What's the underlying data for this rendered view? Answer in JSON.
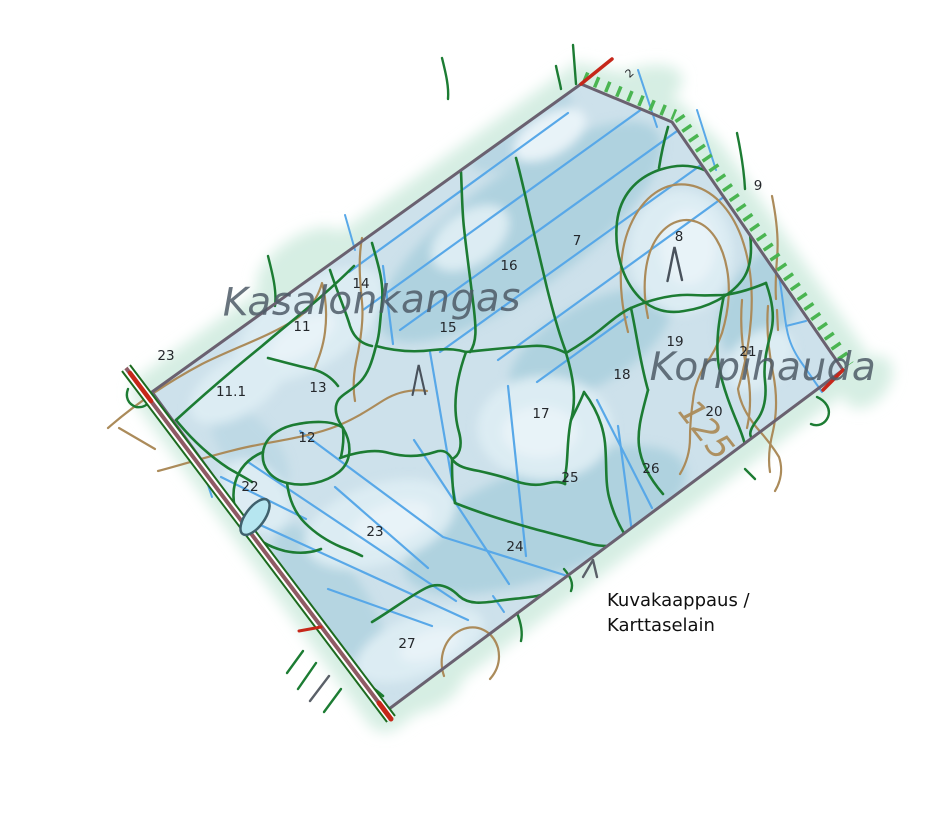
{
  "app": {
    "description": "Karttaselain forest map screenshot"
  },
  "caption": {
    "line1": "Kuvakaappaus /",
    "line2": "Karttaselain"
  },
  "map": {
    "place_names": [
      {
        "text": "Kasalonkangas",
        "x": 372,
        "y": 313,
        "size": 39,
        "rotate": -1
      },
      {
        "text": "Korpihauda",
        "x": 763,
        "y": 380,
        "size": 39,
        "rotate": 0
      }
    ],
    "contour_labels": [
      {
        "text": "125",
        "x": 697,
        "y": 437,
        "size": 34,
        "rotate": 52
      }
    ],
    "parcel_labels": [
      {
        "text": "2",
        "x": 632,
        "y": 76,
        "size": 11,
        "rotate": -42
      },
      {
        "text": "7",
        "x": 577,
        "y": 245
      },
      {
        "text": "8",
        "x": 679,
        "y": 241
      },
      {
        "text": "9",
        "x": 758,
        "y": 190
      },
      {
        "text": "11",
        "x": 302,
        "y": 331
      },
      {
        "text": "11.1",
        "x": 231,
        "y": 396
      },
      {
        "text": "12",
        "x": 307,
        "y": 442
      },
      {
        "text": "13",
        "x": 318,
        "y": 392
      },
      {
        "text": "14",
        "x": 361,
        "y": 288
      },
      {
        "text": "15",
        "x": 448,
        "y": 332
      },
      {
        "text": "16",
        "x": 509,
        "y": 270
      },
      {
        "text": "17",
        "x": 541,
        "y": 418
      },
      {
        "text": "18",
        "x": 622,
        "y": 379
      },
      {
        "text": "19",
        "x": 675,
        "y": 346
      },
      {
        "text": "20",
        "x": 714,
        "y": 416
      },
      {
        "text": "21",
        "x": 748,
        "y": 356
      },
      {
        "text": "22",
        "x": 250,
        "y": 491
      },
      {
        "text": "23",
        "x": 166,
        "y": 360
      },
      {
        "text": "23",
        "x": 375,
        "y": 536
      },
      {
        "text": "24",
        "x": 515,
        "y": 551
      },
      {
        "text": "25",
        "x": 570,
        "y": 482
      },
      {
        "text": "26",
        "x": 651,
        "y": 473
      },
      {
        "text": "27",
        "x": 407,
        "y": 648
      }
    ],
    "terrain_symbols": [
      {
        "type": "hill",
        "x": 420,
        "y": 380,
        "scale": 0.88
      },
      {
        "type": "hill",
        "x": 676,
        "y": 264,
        "scale": 1.0
      }
    ]
  },
  "colors": {
    "background": "#ffffff",
    "map_fill": "#cde1eb",
    "map_fill_dark": "#afd2df",
    "map_fill_light": "#dcecf3",
    "map_fill_lighter": "#e8f3f8",
    "fringe": "#d6eee3",
    "ditch": "#58a8e8",
    "stand_boundary": "#1c7c33",
    "hatch": "#4ab551",
    "contour": "#ab8b5a",
    "property_line": "#6a6170",
    "road_center": "#8f5a64",
    "road_edge": "#1c6b1f",
    "red_mark": "#c6271a",
    "gray_mark": "#5a6068",
    "pond_fill": "#b6e6f0",
    "pond_stroke": "#3f616d",
    "parcel_label": "#24272b",
    "place_name": "#4e5a66",
    "caption": "#101010",
    "symbol": "#49525c"
  }
}
